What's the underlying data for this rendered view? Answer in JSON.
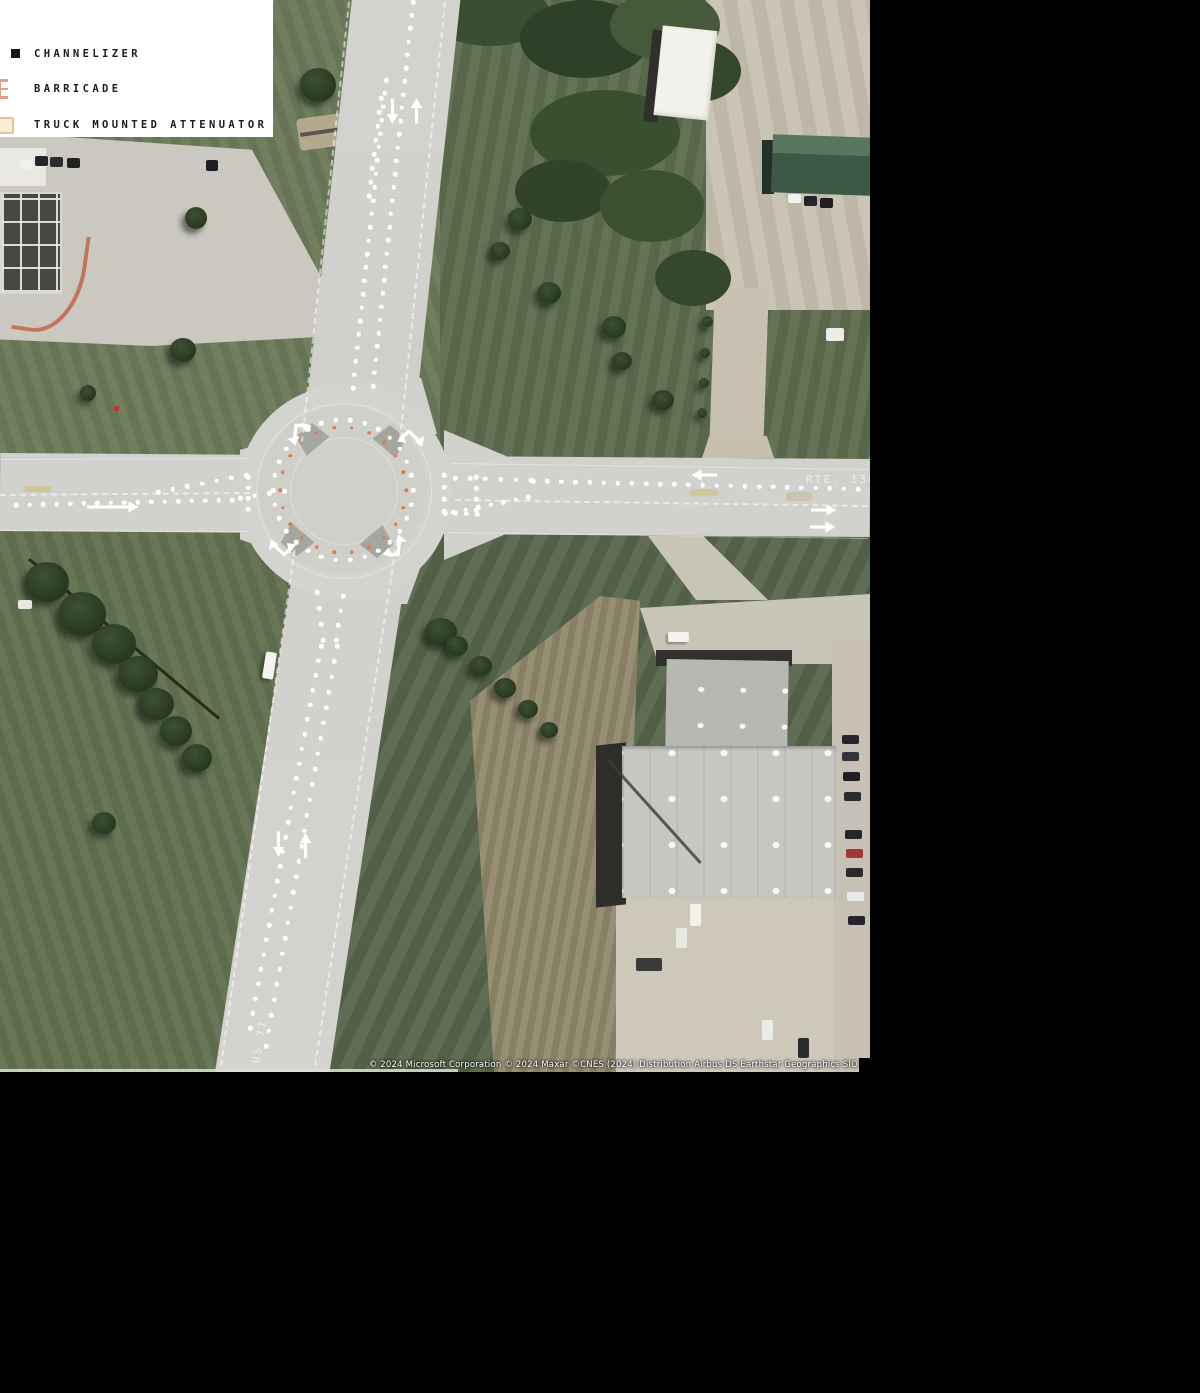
{
  "page": {
    "background": "#000000"
  },
  "legend": {
    "items": [
      {
        "name": "channelizer",
        "label": "CHANNELIZER",
        "icon": "channelizer-square-icon",
        "color": "#161616"
      },
      {
        "name": "barricade",
        "label": "BARRICADE",
        "icon": "barricade-icon",
        "color": "#e59a8e"
      },
      {
        "name": "truck-mounted-attenuator",
        "label": "TRUCK MOUNTED ATTENUATOR",
        "icon": "tma-icon",
        "color": "#eac28d"
      }
    ]
  },
  "map": {
    "labels": [
      {
        "text": "RTE. 136"
      },
      {
        "text": "US 71"
      }
    ],
    "attribution": "© 2024 Microsoft Corporation  © 2024 Maxar  ©CNES (2024) Distribution Airbus DS  Earthstar Geographics  SIO",
    "devices": {
      "channelizer_color": "#ffffff",
      "orange_device_color": "#e07a4e",
      "dot_segments": [
        {
          "from": [
            413,
            2
          ],
          "to": [
            373,
            386
          ],
          "n": 30
        },
        {
          "from": [
            386,
            80
          ],
          "to": [
            353,
            388
          ],
          "n": 24
        },
        {
          "from": [
            381,
            98
          ],
          "to": [
            369,
            196
          ],
          "n": 8
        },
        {
          "from": [
            16,
            505
          ],
          "to": [
            232,
            500
          ],
          "n": 17
        },
        {
          "from": [
            158,
            492
          ],
          "to": [
            246,
            475
          ],
          "n": 7
        },
        {
          "from": [
            248,
            477
          ],
          "to": [
            248,
            509
          ],
          "n": 4
        },
        {
          "from": [
            240,
            498
          ],
          "to": [
            284,
            491
          ],
          "n": 4
        },
        {
          "from": [
            533,
            481
          ],
          "to": [
            858,
            489
          ],
          "n": 24
        },
        {
          "from": [
            455,
            478
          ],
          "to": [
            531,
            480
          ],
          "n": 6
        },
        {
          "from": [
            444,
            475
          ],
          "to": [
            444,
            511
          ],
          "n": 4
        },
        {
          "from": [
            476,
            477
          ],
          "to": [
            476,
            510
          ],
          "n": 4
        },
        {
          "from": [
            528,
            497
          ],
          "to": [
            453,
            512
          ],
          "n": 7
        },
        {
          "from": [
            445,
            513
          ],
          "to": [
            477,
            514
          ],
          "n": 4
        },
        {
          "from": [
            317,
            592
          ],
          "to": [
            323,
            640
          ],
          "n": 4
        },
        {
          "from": [
            343,
            596
          ],
          "to": [
            336,
            640
          ],
          "n": 4
        },
        {
          "from": [
            321,
            646
          ],
          "to": [
            250,
            1028
          ],
          "n": 27
        },
        {
          "from": [
            337,
            646
          ],
          "to": [
            266,
            1046
          ],
          "n": 27
        }
      ],
      "dot_rings": [
        {
          "cx": 343,
          "cy": 490,
          "r": 70,
          "n": 30,
          "color": "#ffffff",
          "size": 4.5
        },
        {
          "cx": 343,
          "cy": 490,
          "r": 63,
          "n": 22,
          "color": "#e07a4e",
          "size": 3.5
        }
      ],
      "lane_arrows": [
        {
          "x": 392,
          "y": 111,
          "dir": "down",
          "len": 26
        },
        {
          "x": 416,
          "y": 111,
          "dir": "up",
          "len": 26
        },
        {
          "x": 112,
          "y": 507,
          "dir": "right",
          "len": 52
        },
        {
          "x": 704,
          "y": 475,
          "dir": "left",
          "len": 26
        },
        {
          "x": 823,
          "y": 510,
          "dir": "right",
          "len": 26
        },
        {
          "x": 822,
          "y": 527,
          "dir": "right",
          "len": 26
        },
        {
          "x": 278,
          "y": 844,
          "dir": "down",
          "len": 26
        },
        {
          "x": 305,
          "y": 846,
          "dir": "up",
          "len": 26
        }
      ],
      "bent_arrows": [
        {
          "x": 298,
          "y": 431,
          "rot": -20,
          "flip": false
        },
        {
          "x": 411,
          "y": 437,
          "rot": 20,
          "flip": true
        },
        {
          "x": 282,
          "y": 549,
          "rot": 200,
          "flip": true
        },
        {
          "x": 396,
          "y": 549,
          "rot": 160,
          "flip": false
        }
      ],
      "lane_lines": [
        {
          "from": [
            0,
            459
          ],
          "to": [
            250,
            458
          ],
          "style": "solid"
        },
        {
          "from": [
            0,
            530
          ],
          "to": [
            250,
            531
          ],
          "style": "solid"
        },
        {
          "from": [
            0,
            494
          ],
          "to": [
            250,
            492
          ],
          "style": "dashed"
        },
        {
          "from": [
            452,
            463
          ],
          "to": [
            868,
            469
          ],
          "style": "solid"
        },
        {
          "from": [
            448,
            532
          ],
          "to": [
            868,
            538
          ],
          "style": "solid"
        },
        {
          "from": [
            455,
            499
          ],
          "to": [
            868,
            505
          ],
          "style": "dashed"
        },
        {
          "from": [
            350,
            2
          ],
          "to": [
            303,
            442
          ],
          "style": "dashed"
        },
        {
          "from": [
            446,
            2
          ],
          "to": [
            401,
            440
          ],
          "style": "dashed"
        },
        {
          "from": [
            398,
            540
          ],
          "to": [
            316,
            1066
          ],
          "style": "dashed"
        },
        {
          "from": [
            297,
            540
          ],
          "to": [
            222,
            1066
          ],
          "style": "dashed"
        }
      ]
    }
  }
}
